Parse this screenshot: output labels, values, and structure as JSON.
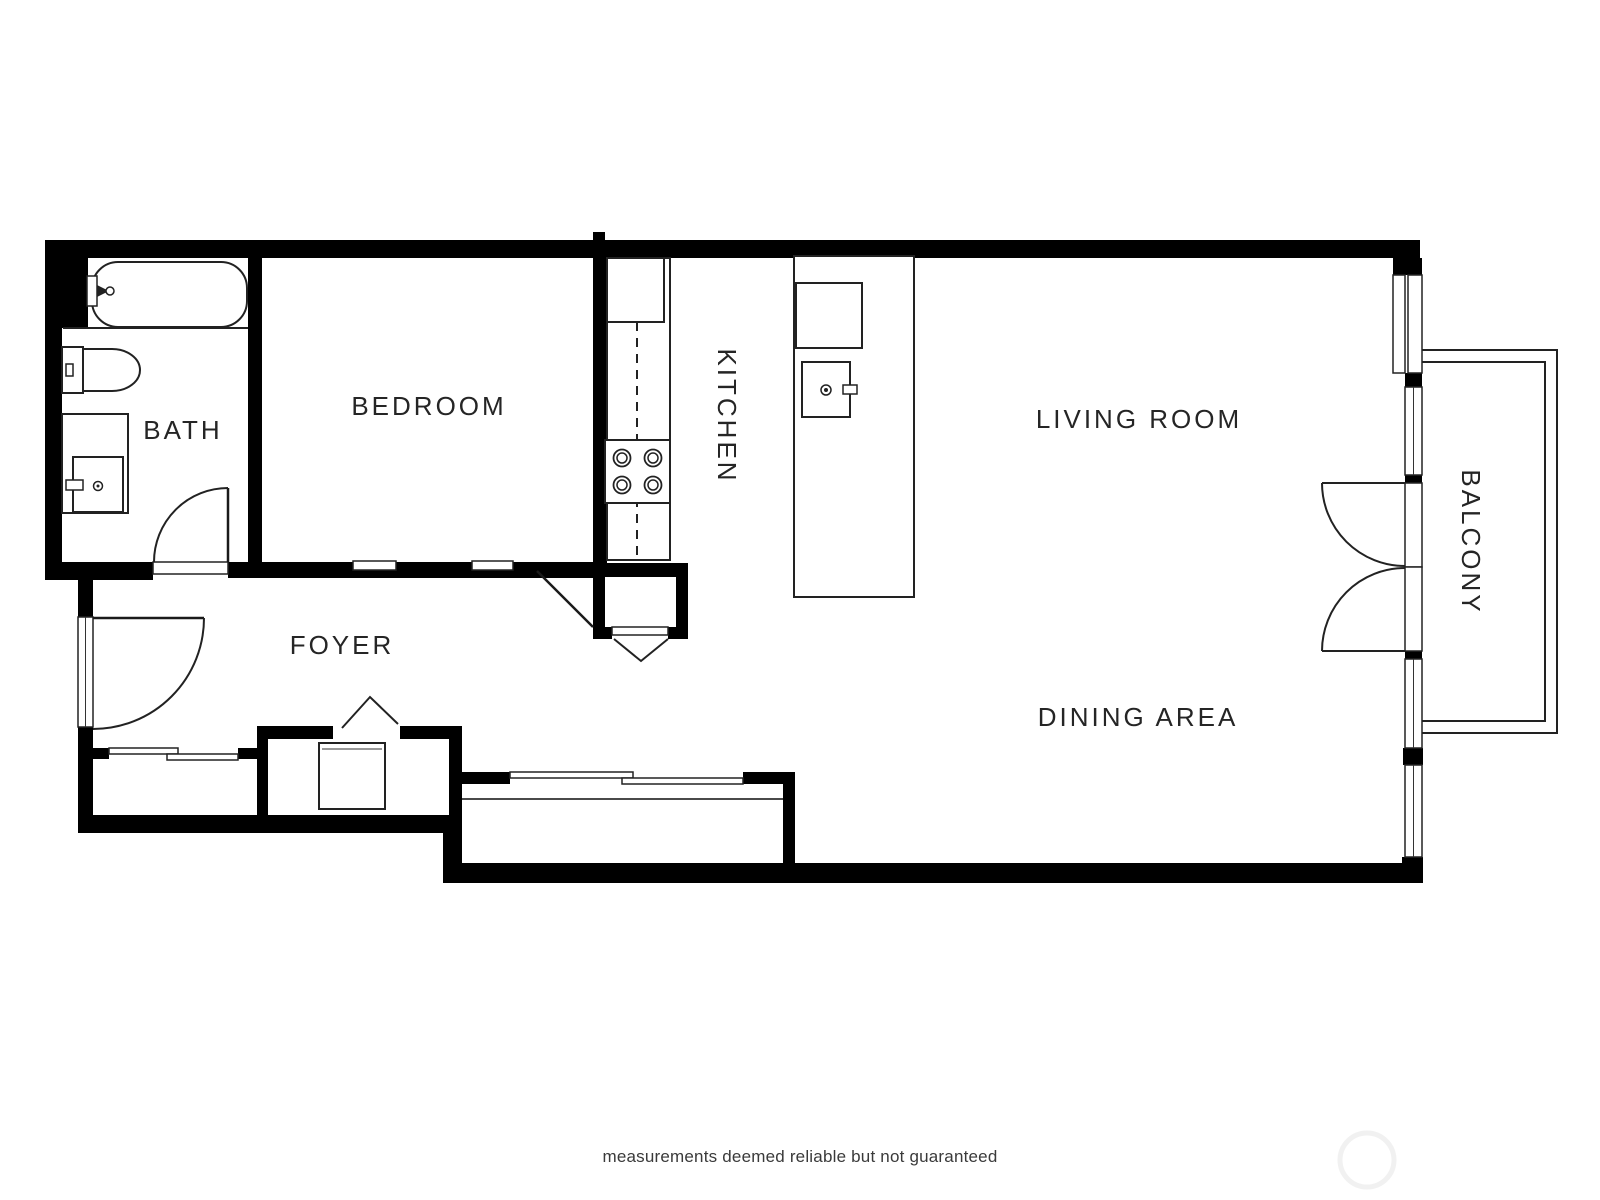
{
  "labels": {
    "bath": "BATH",
    "bedroom": "BEDROOM",
    "kitchen": "KITCHEN",
    "living_room": "LIVING ROOM",
    "dining_area": "DINING AREA",
    "foyer": "FOYER",
    "balcony": "BALCONY"
  },
  "caption": "measurements deemed reliable but not guaranteed",
  "colors": {
    "background": "#ffffff",
    "wall": "#000000",
    "fixture_line": "#222222",
    "label_text": "#252525",
    "caption_text": "#3a3a3a",
    "watermark": "#f1f1f1"
  },
  "fixtures": [
    "bathtub",
    "toilet",
    "vanity-sink",
    "bath-door",
    "entry-door",
    "foyer-closet-sliding-door",
    "laundry-appliance",
    "bifold-door",
    "pantry",
    "kitchen-counter",
    "refrigerator",
    "stove-burners",
    "kitchen-island",
    "island-sink",
    "dining-closet-sliding-door",
    "balcony-french-doors",
    "window-wall"
  ]
}
